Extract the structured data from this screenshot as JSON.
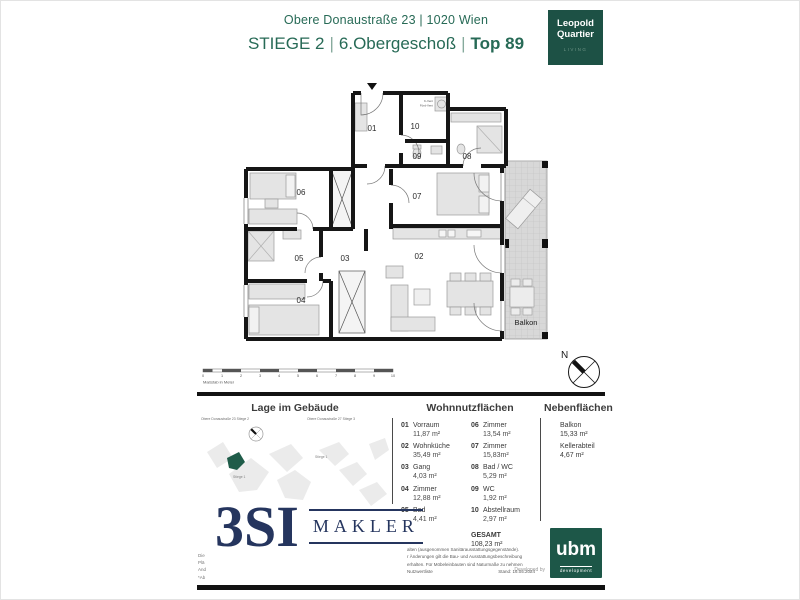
{
  "header": {
    "address": "Obere Donaustraße 23 | 1020 Wien",
    "stiege": "STIEGE 2",
    "sep1": "|",
    "floor": "6.Obergeschoß",
    "sep2": "|",
    "top": "Top 89"
  },
  "brand": {
    "leopold_line1": "Leopold",
    "leopold_line2": "Quartier",
    "leopold_sub": "LIVING"
  },
  "floorplan": {
    "room_labels": {
      "r01": "01",
      "r02": "02",
      "r03": "03",
      "r04": "04",
      "r05": "05",
      "r06": "06",
      "r07": "07",
      "r08": "08",
      "r09": "09",
      "r10": "10"
    },
    "balkon_label": "Balkon",
    "vent_label_1": "K-Vent",
    "vent_label_2": "Förd-Vent"
  },
  "scalebar": {
    "label": "Maßstab in Meter",
    "ticks": [
      "0",
      "1",
      "2",
      "3",
      "4",
      "5",
      "6",
      "7",
      "8",
      "9",
      "10"
    ]
  },
  "compass": {
    "north": "N"
  },
  "location": {
    "title": "Lage im Gebäude",
    "building_left": "Obere Donaustraße 23 Stiege 2",
    "building_right": "Obere Donaustraße 27 Stiege 3",
    "stiege1_a": "Stiege 1",
    "stiege1_b": "Stiege 1"
  },
  "areas": {
    "wohn_title": "Wohnnutzflächen",
    "neben_title": "Nebenflächen",
    "col1": [
      {
        "num": "01",
        "name": "Vorraum",
        "area": "11,87 m²"
      },
      {
        "num": "02",
        "name": "Wohnküche",
        "area": "35,49 m²"
      },
      {
        "num": "03",
        "name": "Gang",
        "area": "4,03 m²"
      },
      {
        "num": "04",
        "name": "Zimmer",
        "area": "12,88 m²"
      },
      {
        "num": "05",
        "name": "Bad",
        "area": "4,41 m²"
      }
    ],
    "col2": [
      {
        "num": "06",
        "name": "Zimmer",
        "area": "13,54 m²"
      },
      {
        "num": "07",
        "name": "Zimmer",
        "area": "15,83m²"
      },
      {
        "num": "08",
        "name": "Bad / WC",
        "area": "5,29 m²"
      },
      {
        "num": "09",
        "name": "WC",
        "area": "1,92 m²"
      },
      {
        "num": "10",
        "name": "Abstellraum",
        "area": "2,97 m²"
      }
    ],
    "gesamt_label": "GESAMT",
    "gesamt_value": "108,23 m²",
    "neben": [
      {
        "name": "Balkon",
        "area": "15,33 m²"
      },
      {
        "name": "Kellerabteil",
        "area": "4,67 m²"
      }
    ]
  },
  "makler": {
    "big": "3SI",
    "word": "MAKLER"
  },
  "footer": {
    "left_fragments": [
      "Die",
      "Plä",
      "And",
      "*Ab"
    ],
    "disclaimer_lines": [
      "alten (ausgenommen Sanitärausstattungsgegenstände).",
      "r Änderungen gilt die Bau- und Ausstattungsbeschreibung",
      "erhalten. Für Möbeleinbauten sind Naturmaße zu nehmen",
      "Nutzwertliste"
    ],
    "stand": "Stand: 16.05.2024",
    "developed_by": "Developed by",
    "ubm_name": "ubm",
    "ubm_sub": "development"
  },
  "colors": {
    "header_green": "#276a56",
    "logo_green": "#1d5145",
    "navy": "#25355e",
    "ubm_green": "#1d5748",
    "unit_green": "#1f5c49"
  }
}
